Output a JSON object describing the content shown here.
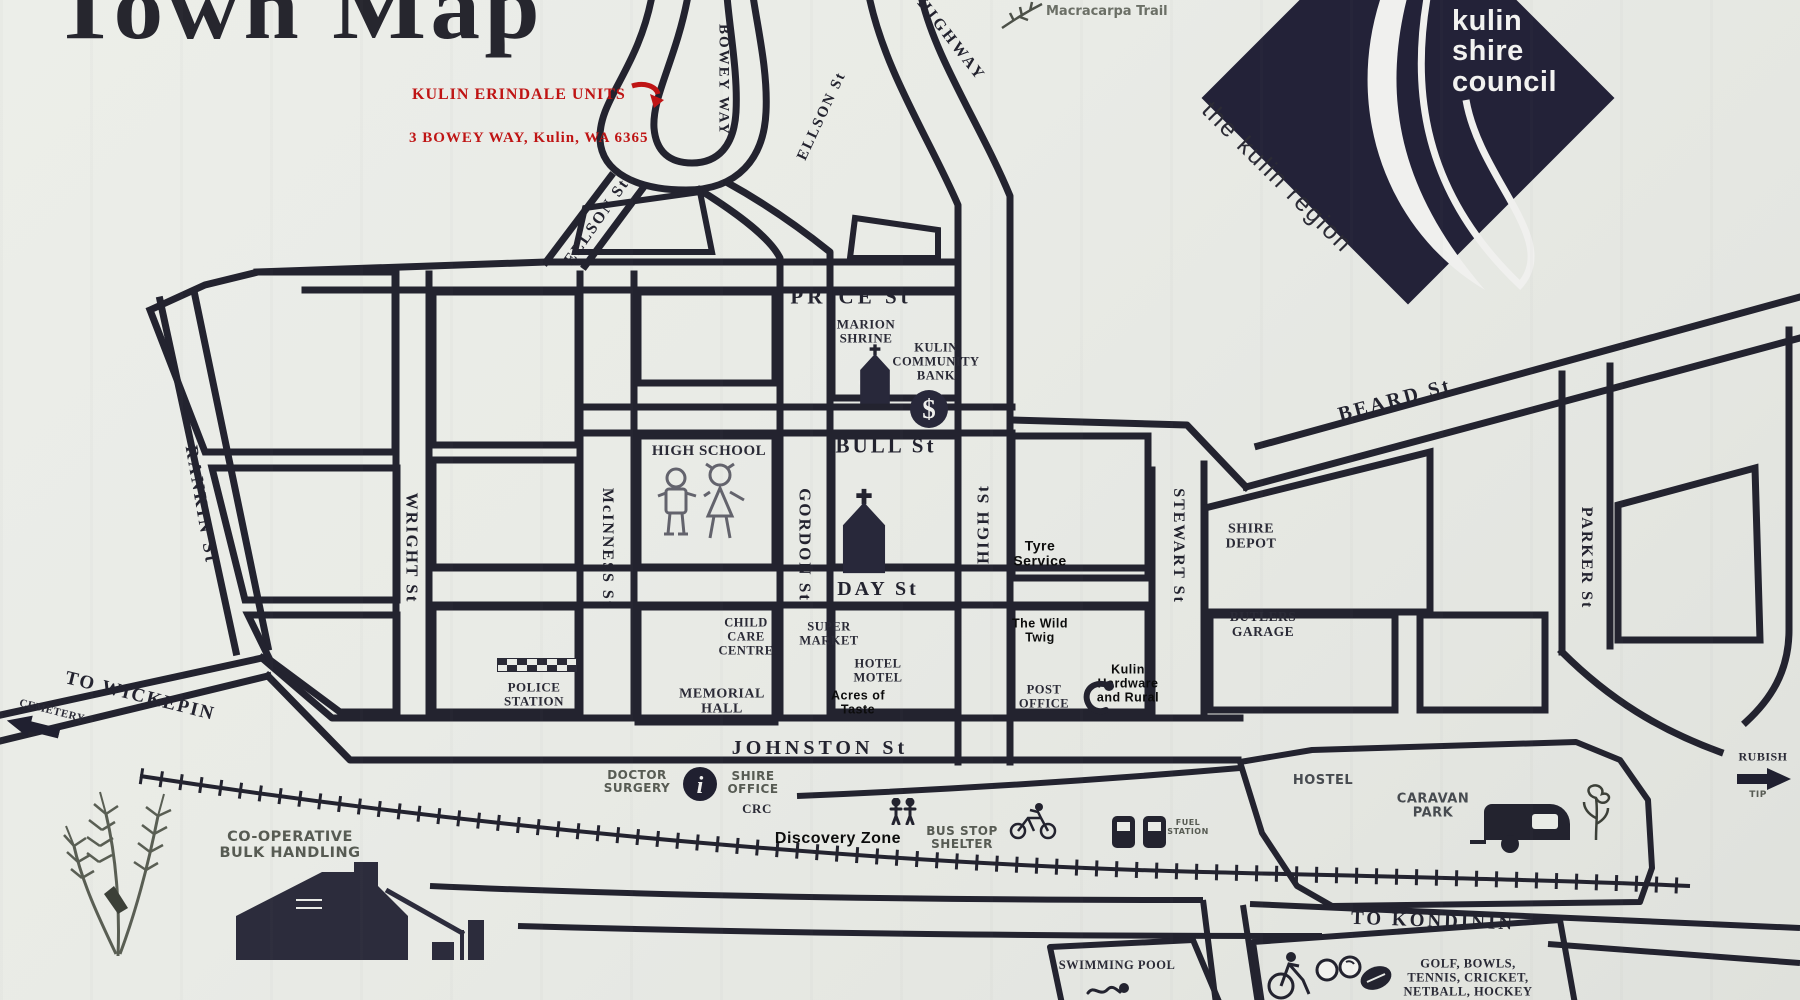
{
  "title": "Town Map",
  "red_notice": {
    "line1": "KULIN ERINDALE UNITS",
    "line2": "3 BOWEY WAY, Kulin, WA 6365"
  },
  "trail_label": "Macracarpa Trail",
  "logo": {
    "line1": "kulin",
    "line2": "shire",
    "line3": "council",
    "tagline": "the kulin region"
  },
  "colors": {
    "ink": "#23232f",
    "paper": "#e9ebe6",
    "red": "#bf1414",
    "logo_navy": "#232238",
    "gray_label": "#575b53"
  },
  "streets": [
    {
      "id": "bowey-way",
      "label": "BOWEY WAY",
      "x": 723,
      "y": 80,
      "rot": 90,
      "size": 15,
      "ls": 2
    },
    {
      "id": "ellson-st-upper",
      "label": "ELLSON St",
      "x": 822,
      "y": 116,
      "rot": -65,
      "size": 15,
      "ls": 2
    },
    {
      "id": "ellson-st-lower",
      "label": "ELLSON  St",
      "x": 597,
      "y": 222,
      "rot": -55,
      "size": 16,
      "ls": 2
    },
    {
      "id": "highway",
      "label": "HIGHWAY",
      "x": 951,
      "y": 40,
      "rot": 52,
      "size": 16,
      "ls": 3
    },
    {
      "id": "price-st",
      "label": "PRICE  St",
      "x": 851,
      "y": 297,
      "rot": 0,
      "size": 21,
      "ls": 4
    },
    {
      "id": "bull-st",
      "label": "BULL  St",
      "x": 886,
      "y": 446,
      "rot": 0,
      "size": 21,
      "ls": 3
    },
    {
      "id": "day-st",
      "label": "DAY      St",
      "x": 878,
      "y": 589,
      "rot": 0,
      "size": 20,
      "ls": 3
    },
    {
      "id": "johnston-st",
      "label": "JOHNSTON  St",
      "x": 820,
      "y": 748,
      "rot": 0,
      "size": 20,
      "ls": 4
    },
    {
      "id": "beard-st",
      "label": "BEARD  St",
      "x": 1395,
      "y": 400,
      "rot": -15,
      "size": 20,
      "ls": 3
    },
    {
      "id": "rankin-st",
      "label": "RANKIN  St",
      "x": 201,
      "y": 505,
      "rot": 80,
      "size": 18,
      "ls": 3
    },
    {
      "id": "wright-st",
      "label": "WRIGHT  St",
      "x": 411,
      "y": 548,
      "rot": 90,
      "size": 17,
      "ls": 2
    },
    {
      "id": "mcinness-st",
      "label": "McINNESS  St",
      "x": 607,
      "y": 548,
      "rot": 90,
      "size": 16,
      "ls": 2
    },
    {
      "id": "gordon-st",
      "label": "GORDON  St",
      "x": 804,
      "y": 545,
      "rot": 90,
      "size": 17,
      "ls": 2
    },
    {
      "id": "high-st",
      "label": "HIGH  St",
      "x": 984,
      "y": 524,
      "rot": -90,
      "size": 17,
      "ls": 2
    },
    {
      "id": "stewart-st",
      "label": "STEWART  St",
      "x": 1178,
      "y": 546,
      "rot": 90,
      "size": 16,
      "ls": 2
    },
    {
      "id": "parker-st",
      "label": "PARKER  St",
      "x": 1586,
      "y": 558,
      "rot": 90,
      "size": 16,
      "ls": 2
    },
    {
      "id": "to-wickepin",
      "label": "TO WICKEPIN",
      "x": 140,
      "y": 697,
      "rot": 14,
      "size": 19,
      "ls": 2
    },
    {
      "id": "to-kondinin",
      "label": "TO KONDININ",
      "x": 1433,
      "y": 922,
      "rot": 2,
      "size": 19,
      "ls": 3
    }
  ],
  "places": [
    {
      "id": "marion-shrine",
      "lines": [
        "MARION",
        "SHRINE"
      ],
      "x": 866,
      "y": 332,
      "size": 13,
      "cls": "serif"
    },
    {
      "id": "community-bank",
      "lines": [
        "KULIN",
        "COMMUNITY",
        "BANK"
      ],
      "x": 936,
      "y": 362,
      "size": 12.5,
      "cls": "serif"
    },
    {
      "id": "high-school",
      "lines": [
        "HIGH SCHOOL"
      ],
      "x": 709,
      "y": 451,
      "size": 15,
      "cls": "serif"
    },
    {
      "id": "church-label-1",
      "lines": [
        "CHURCH"
      ],
      "x": 875,
      "y": 384,
      "size": 7,
      "cls": "white"
    },
    {
      "id": "church-label-2",
      "lines": [
        "CHURCH"
      ],
      "x": 864,
      "y": 547,
      "size": 7.5,
      "cls": "white"
    },
    {
      "id": "tyre-service",
      "lines": [
        "Tyre",
        "Service"
      ],
      "x": 1040,
      "y": 554,
      "size": 14,
      "cls": "annot"
    },
    {
      "id": "shire-depot",
      "lines": [
        "SHIRE",
        "DEPOT"
      ],
      "x": 1251,
      "y": 537,
      "size": 14,
      "cls": "serif"
    },
    {
      "id": "child-care-centre",
      "lines": [
        "CHILD",
        "CARE",
        "CENTRE"
      ],
      "x": 746,
      "y": 637,
      "size": 12.5,
      "cls": "serif"
    },
    {
      "id": "police-station",
      "lines": [
        "POLICE",
        "STATION"
      ],
      "x": 534,
      "y": 695,
      "size": 13,
      "cls": "serif"
    },
    {
      "id": "memorial-hall",
      "lines": [
        "MEMORIAL",
        "HALL"
      ],
      "x": 722,
      "y": 702,
      "size": 14,
      "cls": "serif"
    },
    {
      "id": "super-market",
      "lines": [
        "SUPER",
        "MARKET"
      ],
      "x": 829,
      "y": 634,
      "size": 12.5,
      "cls": "serif"
    },
    {
      "id": "hotel-motel",
      "lines": [
        "HOTEL",
        "MOTEL"
      ],
      "x": 878,
      "y": 671,
      "size": 12.5,
      "cls": "serif"
    },
    {
      "id": "acres-of-taste",
      "lines": [
        "Acres of",
        "Taste"
      ],
      "x": 858,
      "y": 703,
      "size": 12.5,
      "cls": "annot"
    },
    {
      "id": "the-wild-twig",
      "lines": [
        "The Wild",
        "Twig"
      ],
      "x": 1040,
      "y": 631,
      "size": 12.5,
      "cls": "annot"
    },
    {
      "id": "post-office",
      "lines": [
        "POST",
        "OFFICE"
      ],
      "x": 1044,
      "y": 697,
      "size": 12.5,
      "cls": "serif"
    },
    {
      "id": "kulin-hardware",
      "lines": [
        "Kulin",
        "Hardware",
        "and Rural"
      ],
      "x": 1128,
      "y": 684,
      "size": 12.5,
      "cls": "annot"
    },
    {
      "id": "butlers-garage",
      "lines": [
        "BUTLERS",
        "GARAGE"
      ],
      "x": 1263,
      "y": 625,
      "size": 13.5,
      "cls": "serif"
    },
    {
      "id": "doctor-surgery",
      "lines": [
        "DOCTOR",
        "SURGERY"
      ],
      "x": 637,
      "y": 782,
      "size": 12,
      "cls": "gray"
    },
    {
      "id": "shire-office",
      "lines": [
        "SHIRE",
        "OFFICE"
      ],
      "x": 753,
      "y": 783,
      "size": 12,
      "cls": "gray"
    },
    {
      "id": "crc",
      "lines": [
        "CRC"
      ],
      "x": 757,
      "y": 809,
      "size": 13,
      "cls": "serif"
    },
    {
      "id": "discovery-zone",
      "lines": [
        "Discovery Zone"
      ],
      "x": 838,
      "y": 839,
      "size": 16,
      "cls": "annot"
    },
    {
      "id": "bus-stop-shelter",
      "lines": [
        "BUS STOP",
        "SHELTER"
      ],
      "x": 962,
      "y": 838,
      "size": 12,
      "cls": "gray"
    },
    {
      "id": "fuel-station",
      "lines": [
        "FUEL",
        "STATION"
      ],
      "x": 1188,
      "y": 828,
      "size": 8,
      "cls": "gray"
    },
    {
      "id": "hostel",
      "lines": [
        "HOSTEL"
      ],
      "x": 1323,
      "y": 781,
      "size": 13,
      "cls": "graydark"
    },
    {
      "id": "caravan-park",
      "lines": [
        "CARAVAN",
        "PARK"
      ],
      "x": 1433,
      "y": 807,
      "size": 13,
      "cls": "graydark"
    },
    {
      "id": "cemetery",
      "lines": [
        "CEMETERY"
      ],
      "x": 52,
      "y": 711,
      "size": 11,
      "cls": "serif",
      "rot": 14
    },
    {
      "id": "rubish",
      "lines": [
        "RUBISH"
      ],
      "x": 1763,
      "y": 757,
      "size": 12,
      "cls": "serif"
    },
    {
      "id": "tip",
      "lines": [
        "TIP"
      ],
      "x": 1758,
      "y": 796,
      "size": 9,
      "cls": "gray"
    },
    {
      "id": "co-op-bulk-handling",
      "lines": [
        "CO-OPERATIVE",
        "BULK HANDLING"
      ],
      "x": 290,
      "y": 846,
      "size": 14.5,
      "cls": "gray"
    },
    {
      "id": "swimming-pool",
      "lines": [
        "SWIMMING POOL"
      ],
      "x": 1117,
      "y": 966,
      "size": 12.5,
      "cls": "serif"
    },
    {
      "id": "golf-bowls",
      "lines": [
        "GOLF, BOWLS,",
        "TENNIS, CRICKET,",
        "NETBALL, HOCKEY"
      ],
      "x": 1468,
      "y": 978,
      "size": 12.5,
      "cls": "serif"
    }
  ],
  "icons": [
    {
      "name": "church-icon",
      "symbol": "church",
      "x": 845,
      "y": 343,
      "w": 60,
      "h": 62
    },
    {
      "name": "church-icon",
      "symbol": "church",
      "x": 833,
      "y": 487,
      "w": 62,
      "h": 88
    },
    {
      "name": "dollar-bank-icon",
      "symbol": "dollar",
      "x": 908,
      "y": 388,
      "w": 42,
      "h": 42
    },
    {
      "name": "children-icon",
      "symbol": "children",
      "x": 652,
      "y": 462,
      "w": 102,
      "h": 88
    },
    {
      "name": "checker-police-icon",
      "symbol": "checker",
      "x": 497,
      "y": 658,
      "w": 80,
      "h": 14
    },
    {
      "name": "info-icon",
      "symbol": "info",
      "x": 682,
      "y": 766,
      "w": 36,
      "h": 36
    },
    {
      "name": "phone-icon",
      "symbol": "phone",
      "x": 1078,
      "y": 678,
      "w": 38,
      "h": 38
    },
    {
      "name": "pedestrians-icon",
      "symbol": "persons",
      "x": 888,
      "y": 798,
      "w": 30,
      "h": 27
    },
    {
      "name": "cyclist-icon",
      "symbol": "cyclist",
      "x": 1008,
      "y": 802,
      "w": 50,
      "h": 38
    },
    {
      "name": "fuel-pumps-icon",
      "symbol": "fuel",
      "x": 1110,
      "y": 812,
      "w": 58,
      "h": 38
    },
    {
      "name": "caravan-icon",
      "symbol": "caravan",
      "x": 1470,
      "y": 796,
      "w": 108,
      "h": 58
    },
    {
      "name": "flower-icon",
      "symbol": "flower",
      "x": 1578,
      "y": 784,
      "w": 36,
      "h": 58
    },
    {
      "name": "wheat-icon",
      "symbol": "wheat",
      "x": 58,
      "y": 786,
      "w": 140,
      "h": 172
    },
    {
      "name": "grain-shed-icon",
      "symbol": "shed",
      "x": 236,
      "y": 860,
      "w": 252,
      "h": 102
    },
    {
      "name": "swimmer-icon",
      "symbol": "swimmer",
      "x": 1086,
      "y": 980,
      "w": 46,
      "h": 20
    },
    {
      "name": "sports-icons",
      "symbol": "sports",
      "x": 1263,
      "y": 950,
      "w": 132,
      "h": 50
    },
    {
      "name": "cemetery-arrow-icon",
      "symbol": "arrowleft",
      "x": 6,
      "y": 716,
      "w": 54,
      "h": 22,
      "rot": 14
    },
    {
      "name": "rubbish-arrow-icon",
      "symbol": "arrowright",
      "x": 1736,
      "y": 768,
      "w": 56,
      "h": 22
    },
    {
      "name": "red-arrow-icon",
      "symbol": "redarrow",
      "x": 630,
      "y": 80,
      "w": 36,
      "h": 30
    },
    {
      "name": "branch-icon",
      "symbol": "branch",
      "x": 1000,
      "y": 0,
      "w": 44,
      "h": 30
    }
  ]
}
